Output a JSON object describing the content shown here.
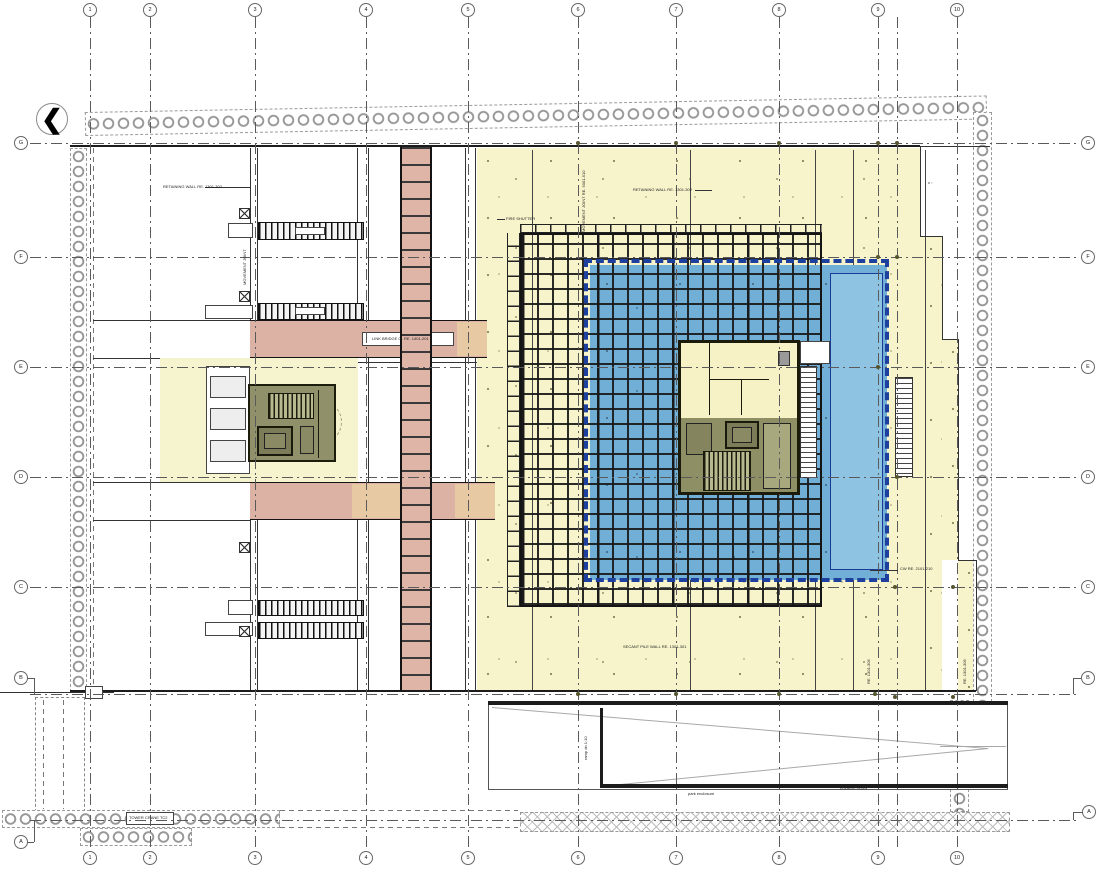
{
  "title": "basement floor plan",
  "palette": {
    "plate_yellow": "#f7f4cb",
    "pad_yellow": "#f6f3cf",
    "pool_blue": "#72afd6",
    "pool_blue_light": "#8fc3e2",
    "navy_dashed_border": "#1d3f9e",
    "corridor_pink": "#dcb2a4",
    "corridor_tan": "#e7c9a4",
    "core_olive": "#90906a",
    "core_wall_dark": "#1d1d0d",
    "grid_line": "#5a5a5a",
    "structure_black": "#141414",
    "pile_circle_gray": "#979797"
  },
  "north_arrow": {
    "symbol": "❮"
  },
  "grid": {
    "columns": [
      {
        "id": "1",
        "x": 90
      },
      {
        "id": "2",
        "x": 150
      },
      {
        "id": "3",
        "x": 255
      },
      {
        "id": "4",
        "x": 366
      },
      {
        "id": "5",
        "x": 468
      },
      {
        "id": "6",
        "x": 578
      },
      {
        "id": "7",
        "x": 676
      },
      {
        "id": "8",
        "x": 779
      },
      {
        "id": "9",
        "x": 878
      },
      {
        "id": "",
        "x": 897,
        "bubbles": false
      },
      {
        "id": "10",
        "x": 957
      }
    ],
    "rows": [
      {
        "id": "G",
        "line_y": 143,
        "left": {
          "x": 21,
          "y": 143
        },
        "right": {
          "x": 1088,
          "y": 143
        }
      },
      {
        "id": "F",
        "line_y": 257,
        "left": {
          "x": 21,
          "y": 257
        },
        "right": {
          "x": 1088,
          "y": 257
        }
      },
      {
        "id": "E",
        "line_y": 367,
        "left": {
          "x": 21,
          "y": 367
        },
        "right": {
          "x": 1088,
          "y": 367
        }
      },
      {
        "id": "D",
        "line_y": 477,
        "left": {
          "x": 21,
          "y": 477
        },
        "right": {
          "x": 1088,
          "y": 477
        }
      },
      {
        "id": "C",
        "line_y": 587,
        "left": {
          "x": 21,
          "y": 587
        },
        "right": {
          "x": 1088,
          "y": 587
        }
      },
      {
        "id": "B",
        "line_y": 694,
        "left": {
          "x": 21,
          "y": 678
        },
        "right": {
          "x": 1088,
          "y": 678
        }
      },
      {
        "id": "A",
        "line_y": 820,
        "left": {
          "x": 21,
          "y": 842
        },
        "right": {
          "x": 1089,
          "y": 812
        }
      }
    ]
  },
  "annotations": [
    {
      "id": "retaining-wall-left",
      "text": "RETAINING WALL RE. 1301-302",
      "x": 163,
      "y": 184
    },
    {
      "id": "retaining-wall-mid",
      "text": "RETAINING WALL RE. 1301-302",
      "x": 633,
      "y": 187
    },
    {
      "id": "movement-joint-mid",
      "text": "MOVEMENT JOINT RE. 5001-510",
      "x": 581,
      "y": 232,
      "rot": -90
    },
    {
      "id": "fire-shutter",
      "text": "FIRE SHUTTER",
      "x": 506,
      "y": 216
    },
    {
      "id": "link-bridge",
      "text": "LINK BRIDGE 01 RE. 1401-201",
      "x": 372,
      "y": 336
    },
    {
      "id": "secant-pile-1",
      "text": "SECANT PILE WALL RE. 1301-301",
      "x": 540,
      "y": 602
    },
    {
      "id": "secant-pile-2",
      "text": "SECANT PILE WALL RE. 1301-301",
      "x": 623,
      "y": 644
    },
    {
      "id": "park-enclosure",
      "text": "park enclosure",
      "x": 688,
      "y": 791
    },
    {
      "id": "entrance-below",
      "text": "entrance below",
      "x": 840,
      "y": 785
    },
    {
      "id": "ramp-dn",
      "text": "ramp dn 1:10",
      "x": 583,
      "y": 760,
      "rot": -90
    },
    {
      "id": "movement-joint-left",
      "text": "MOVEMENT JOINT",
      "x": 242,
      "y": 285,
      "rot": -90
    },
    {
      "id": "tower-crane",
      "text": "TOWER CRANE TC2",
      "x": 129,
      "y": 815
    },
    {
      "id": "cw-note",
      "text": "CW RE. 2101-210",
      "x": 900,
      "y": 566
    },
    {
      "id": "re-note-1",
      "text": "RE. 1301-305",
      "x": 866,
      "y": 684,
      "rot": -90
    },
    {
      "id": "re-note-2",
      "text": "RE. 1301-305",
      "x": 962,
      "y": 684,
      "rot": -90
    },
    {
      "id": "setting-out",
      "text": "x  ▫",
      "x": 928,
      "y": 180
    }
  ],
  "markers": [
    [
      578,
      143
    ],
    [
      676,
      143
    ],
    [
      779,
      143
    ],
    [
      878,
      143
    ],
    [
      897,
      143
    ],
    [
      878,
      257
    ],
    [
      897,
      257
    ],
    [
      878,
      367
    ],
    [
      897,
      477
    ],
    [
      895,
      587
    ],
    [
      953,
      587
    ],
    [
      578,
      694
    ],
    [
      676,
      694
    ],
    [
      779,
      694
    ],
    [
      875,
      694
    ],
    [
      895,
      697
    ],
    [
      953,
      697
    ]
  ]
}
